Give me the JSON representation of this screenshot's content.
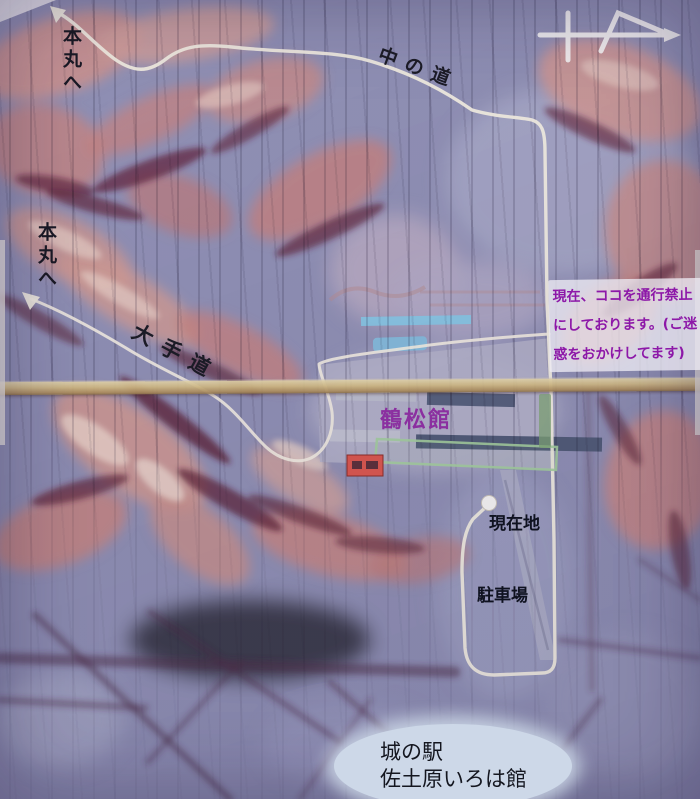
{
  "map": {
    "labels": {
      "honmaru_top": "本丸へ",
      "honmaru_left": "本丸へ",
      "naka_no_michi": "中の道",
      "ote_do": "大手道",
      "kakushokan": "鶴松館",
      "current_location": "現在地",
      "parking": "駐車場"
    },
    "notice": {
      "line1": "現在、ココを通行禁止",
      "line2": "にしております。(ご迷",
      "line3": "惑をおかけしてます)"
    },
    "station": {
      "line1": "城の駅",
      "line2": "佐土原いろは館"
    },
    "colors": {
      "route": "#f7f3e4",
      "notice_text": "#8d18a8",
      "kakushokan_text": "#8b2fa0",
      "label_dark": "#14161f",
      "green_outline": "#a6d49e",
      "hedge_green": "#7fa873",
      "red_marker": "#e0574a",
      "seam": "#d3bd80",
      "station_bg": "#cdd8e8",
      "dot": "#fdfdf8",
      "compass": "#fbfbf7"
    }
  }
}
